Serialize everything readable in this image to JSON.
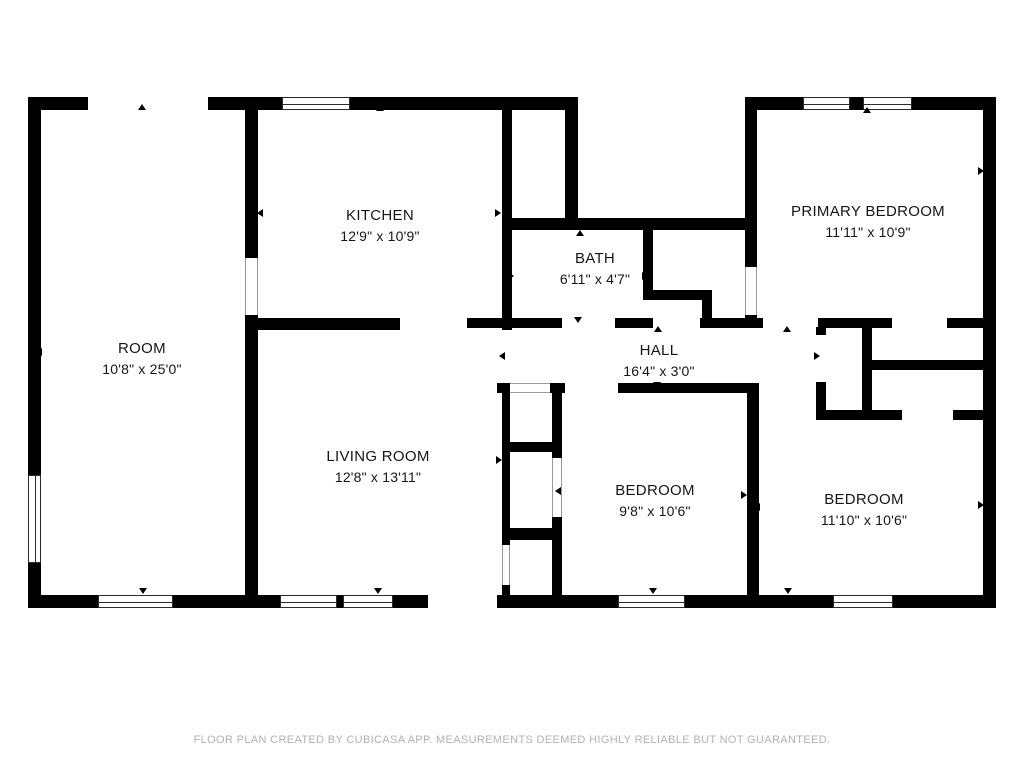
{
  "footer": {
    "text": "FLOOR PLAN CREATED BY CUBICASA APP. MEASUREMENTS DEEMED HIGHLY RELIABLE BUT NOT GUARANTEED."
  },
  "colors": {
    "wall": "#000000",
    "label_text": "#161616",
    "footer_text": "#b2b2b2",
    "window_frame": "#2b2b2b",
    "background": "#ffffff"
  },
  "rooms": [
    {
      "id": "room",
      "name": "ROOM",
      "dims": "10'8\" x 25'0\"",
      "x": 142,
      "y": 338
    },
    {
      "id": "kitchen",
      "name": "KITCHEN",
      "dims": "12'9\" x 10'9\"",
      "x": 380,
      "y": 205
    },
    {
      "id": "bath",
      "name": "BATH",
      "dims": "6'11\" x 4'7\"",
      "x": 595,
      "y": 248
    },
    {
      "id": "primary-bedroom",
      "name": "PRIMARY BEDROOM",
      "dims": "11'11\" x 10'9\"",
      "x": 868,
      "y": 201
    },
    {
      "id": "hall",
      "name": "HALL",
      "dims": "16'4\" x 3'0\"",
      "x": 659,
      "y": 340
    },
    {
      "id": "living-room",
      "name": "LIVING ROOM",
      "dims": "12'8\" x 13'11\"",
      "x": 378,
      "y": 446
    },
    {
      "id": "bedroom-middle",
      "name": "BEDROOM",
      "dims": "9'8\" x 10'6\"",
      "x": 655,
      "y": 480
    },
    {
      "id": "bedroom-right",
      "name": "BEDROOM",
      "dims": "11'10\" x 10'6\"",
      "x": 864,
      "y": 489
    }
  ],
  "geometry": {
    "walls": [
      [
        28,
        97,
        60,
        13
      ],
      [
        208,
        97,
        74,
        13
      ],
      [
        350,
        97,
        228,
        13
      ],
      [
        745,
        97,
        58,
        13
      ],
      [
        850,
        97,
        13,
        13
      ],
      [
        912,
        97,
        84,
        13
      ],
      [
        28,
        97,
        13,
        378
      ],
      [
        28,
        563,
        13,
        45
      ],
      [
        983,
        97,
        13,
        511
      ],
      [
        28,
        595,
        70,
        13
      ],
      [
        173,
        595,
        107,
        13
      ],
      [
        337,
        595,
        6,
        13
      ],
      [
        393,
        595,
        35,
        13
      ],
      [
        497,
        595,
        121,
        13
      ],
      [
        685,
        595,
        148,
        13
      ],
      [
        893,
        595,
        103,
        13
      ],
      [
        245,
        110,
        13,
        148
      ],
      [
        245,
        315,
        13,
        280
      ],
      [
        245,
        318,
        155,
        12
      ],
      [
        502,
        110,
        10,
        220
      ],
      [
        565,
        110,
        13,
        112
      ],
      [
        502,
        218,
        255,
        12
      ],
      [
        643,
        230,
        10,
        62
      ],
      [
        643,
        290,
        69,
        10
      ],
      [
        702,
        300,
        10,
        28
      ],
      [
        745,
        97,
        12,
        170
      ],
      [
        745,
        315,
        12,
        13
      ],
      [
        467,
        318,
        95,
        10
      ],
      [
        615,
        318,
        38,
        10
      ],
      [
        700,
        318,
        63,
        10
      ],
      [
        818,
        318,
        74,
        10
      ],
      [
        947,
        318,
        36,
        10
      ],
      [
        497,
        383,
        13,
        10
      ],
      [
        550,
        383,
        15,
        10
      ],
      [
        618,
        383,
        141,
        10
      ],
      [
        747,
        383,
        12,
        212
      ],
      [
        816,
        327,
        10,
        8
      ],
      [
        816,
        382,
        10,
        38
      ],
      [
        862,
        327,
        10,
        85
      ],
      [
        867,
        360,
        116,
        10
      ],
      [
        817,
        410,
        85,
        10
      ],
      [
        953,
        410,
        30,
        10
      ],
      [
        502,
        385,
        8,
        160
      ],
      [
        502,
        585,
        8,
        10
      ],
      [
        552,
        385,
        10,
        73
      ],
      [
        552,
        517,
        10,
        78
      ],
      [
        507,
        442,
        50,
        10
      ],
      [
        507,
        528,
        50,
        12
      ]
    ],
    "windows": [
      [
        282,
        97,
        68,
        13,
        "h"
      ],
      [
        803,
        97,
        47,
        13,
        "h"
      ],
      [
        863,
        97,
        49,
        13,
        "h"
      ],
      [
        28,
        475,
        13,
        88,
        "v"
      ],
      [
        98,
        595,
        75,
        13,
        "h"
      ],
      [
        280,
        595,
        57,
        13,
        "h"
      ],
      [
        343,
        595,
        50,
        13,
        "h"
      ],
      [
        618,
        595,
        67,
        13,
        "h"
      ],
      [
        833,
        595,
        60,
        13,
        "h"
      ]
    ],
    "openings": [
      [
        245,
        258,
        13,
        57,
        "v"
      ],
      [
        745,
        267,
        12,
        48,
        "v"
      ],
      [
        502,
        545,
        8,
        40,
        "v"
      ],
      [
        552,
        458,
        10,
        59,
        "v"
      ],
      [
        510,
        383,
        40,
        10,
        "h"
      ]
    ],
    "markers": [
      [
        142,
        108,
        "up"
      ],
      [
        380,
        109,
        "up"
      ],
      [
        867,
        111,
        "up"
      ],
      [
        40,
        352,
        "left"
      ],
      [
        753,
        170,
        "left"
      ],
      [
        982,
        171,
        "right"
      ],
      [
        261,
        213,
        "left"
      ],
      [
        499,
        213,
        "right"
      ],
      [
        512,
        276,
        "right"
      ],
      [
        646,
        276,
        "right"
      ],
      [
        580,
        234,
        "up"
      ],
      [
        578,
        321,
        "down"
      ],
      [
        658,
        330,
        "up"
      ],
      [
        787,
        330,
        "up"
      ],
      [
        503,
        356,
        "left"
      ],
      [
        818,
        356,
        "right"
      ],
      [
        657,
        386,
        "down"
      ],
      [
        500,
        460,
        "right"
      ],
      [
        559,
        491,
        "left"
      ],
      [
        745,
        495,
        "right"
      ],
      [
        758,
        507,
        "left"
      ],
      [
        982,
        505,
        "right"
      ],
      [
        143,
        592,
        "down"
      ],
      [
        378,
        592,
        "down"
      ],
      [
        653,
        592,
        "down"
      ],
      [
        788,
        592,
        "down"
      ]
    ]
  }
}
